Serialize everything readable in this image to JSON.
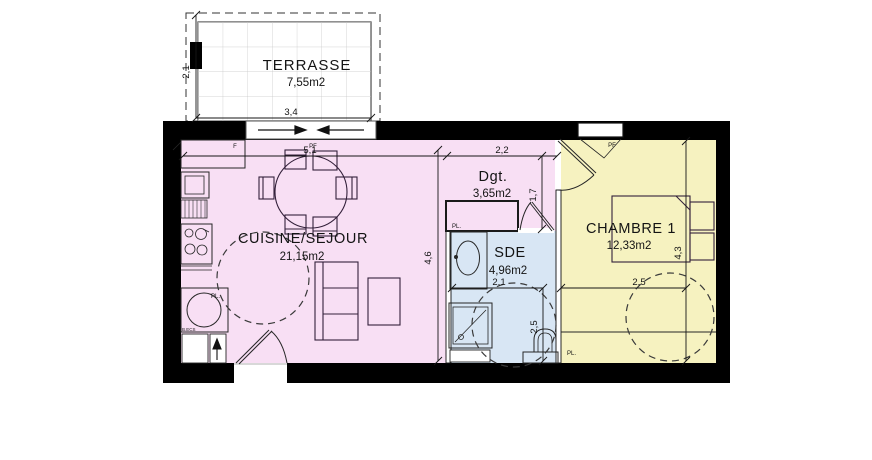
{
  "drawing": {
    "type": "floor-plan"
  },
  "rooms": {
    "terrasse": {
      "name": "TERRASSE",
      "area": "7,55m2"
    },
    "cuisine_sejour": {
      "name": "CUISINE/SEJOUR",
      "area": "21,15m2"
    },
    "degagement": {
      "name": "Dgt.",
      "area": "3,65m2"
    },
    "sde": {
      "name": "SDE",
      "area": "4,96m2"
    },
    "chambre": {
      "name": "CHAMBRE 1",
      "area": "12,33m2"
    }
  },
  "dimensions": {
    "terrasse_depth": "2,1",
    "terrasse_width": "3,4",
    "sejour_width": "5,1",
    "sejour_depth": "4,6",
    "degagement_width": "2,2",
    "degagement_depth": "1,7",
    "sde_width": "2,1",
    "sde_depth": "2,5",
    "chambre_width": "2,5",
    "chambre_depth": "4,3"
  },
  "openings": {
    "window_f_label": "F",
    "bay_window_label": "PF",
    "chambre_window_label": "PF"
  },
  "fixtures": {
    "closet_degagement_label": "PL.",
    "water_heater_label": "PL.",
    "closet_chambre_label": "PL.",
    "water_heater_note": "B.ECS"
  },
  "colors": {
    "cuisine_fill": "#f8dff4",
    "sde_fill": "#d8e6f4",
    "chambre_fill": "#f6f2c0",
    "wall": "#000000"
  }
}
